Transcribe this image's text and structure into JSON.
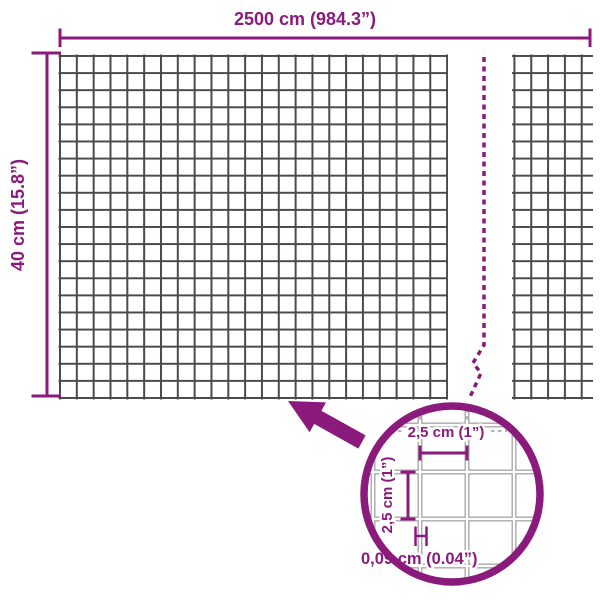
{
  "colors": {
    "accent": "#8B1A7D",
    "meshWire": "#4A4A4A",
    "lensWire": "#A9A9A9",
    "background": "#FFFFFF"
  },
  "labels": {
    "total_width": "2500 cm (984.3”)",
    "total_height": "40 cm (15.8”)"
  },
  "lens": {
    "cell_width": "2,5 cm (1”)",
    "cell_height": "2,5 cm (1”)",
    "wire_thickness": "0,09 cm (0.04”)"
  }
}
